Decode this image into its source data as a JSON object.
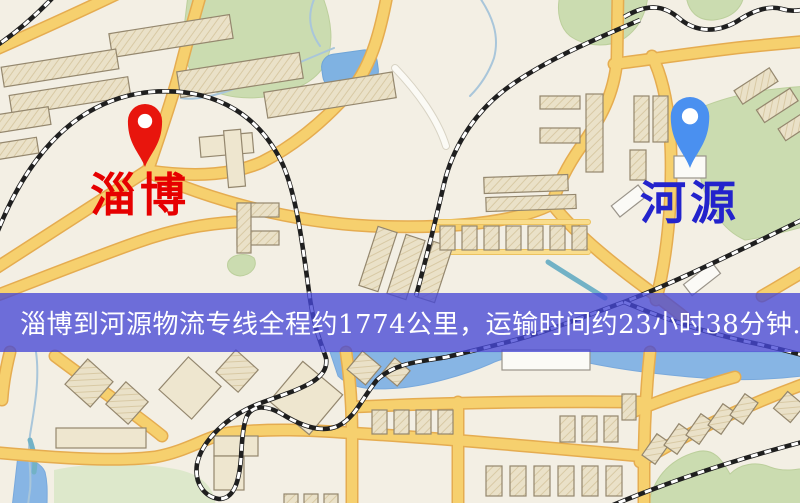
{
  "app": {
    "type": "map-route-screenshot"
  },
  "map": {
    "origin_marker": {
      "label": "淄博",
      "icon": "location-pin-icon",
      "pin_color": "#e8150d",
      "label_color": "#e60000"
    },
    "destination_marker": {
      "label": "河源",
      "icon": "location-pin-icon",
      "pin_color": "#4a90f0",
      "label_color": "#2323cc"
    },
    "banner": {
      "text": "淄博到河源物流专线全程约1774公里，运输时间约23小时38分钟.",
      "route_origin": "淄博",
      "route_destination": "河源",
      "distance": "约1774公里",
      "duration": "约23小时38分钟",
      "bg_color": "#4648d6",
      "text_color": "#ffffff"
    },
    "legend_colors": {
      "background": "#f3efe4",
      "road": "#f6d06e",
      "road_casing": "#e5ac50",
      "water": "#87b5e4",
      "park": "#cbdcb0",
      "building": "#eae1c8",
      "railway": "#1f1f1f"
    }
  }
}
